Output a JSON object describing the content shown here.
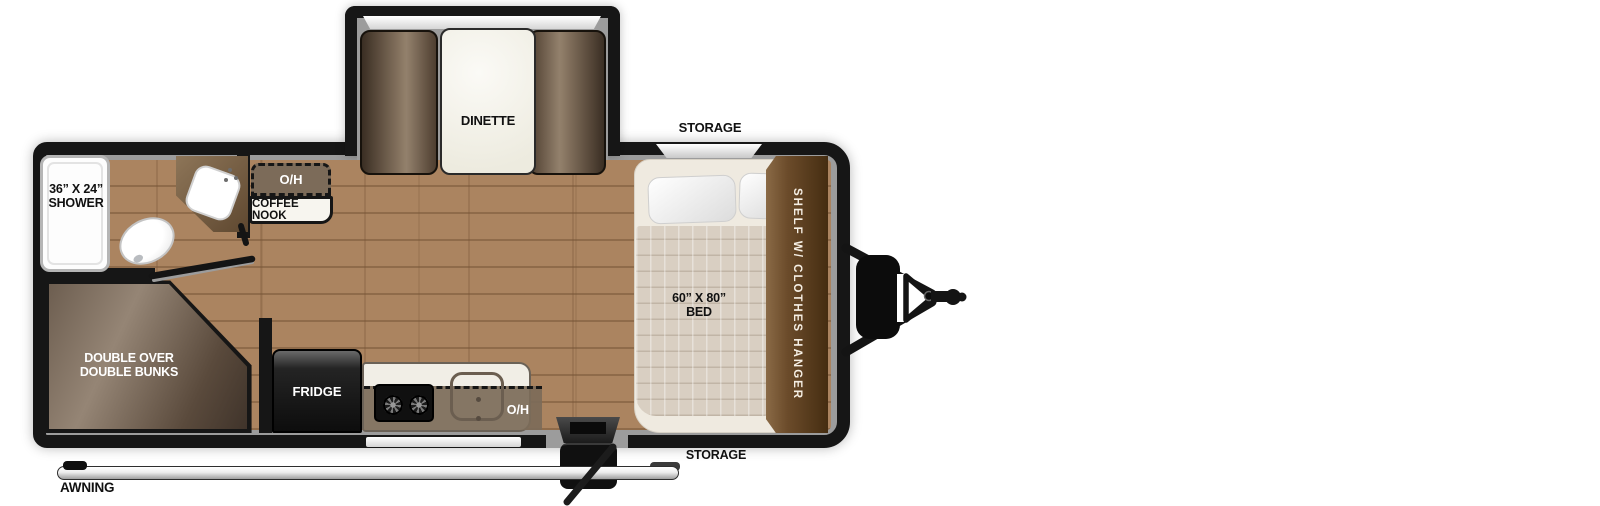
{
  "floorplan": {
    "slideout": {
      "dinette_label": "DINETTE"
    },
    "storage_top": "STORAGE",
    "storage_bottom": "STORAGE",
    "bathroom": {
      "shower_size": "36” X 24”",
      "shower_label": "SHOWER"
    },
    "coffee_nook": {
      "overhead": "O/H",
      "label": "COFFEE NOOK"
    },
    "bunks": {
      "line1": "DOUBLE OVER",
      "line2": "DOUBLE BUNKS"
    },
    "kitchen": {
      "fridge": "FRIDGE",
      "overhead": "O/H"
    },
    "bedroom": {
      "bed_size": "60” X 80”",
      "bed_label": "BED",
      "wardrobe": "SHELF W/ CLOTHES HANGER"
    },
    "awning": "AWNING",
    "colors": {
      "wall": "#161616",
      "liner": "#9c9c9c",
      "floor": "#ab8460",
      "cabinet": "#6b4b2a",
      "counter-oh": "#7c6b59"
    }
  }
}
